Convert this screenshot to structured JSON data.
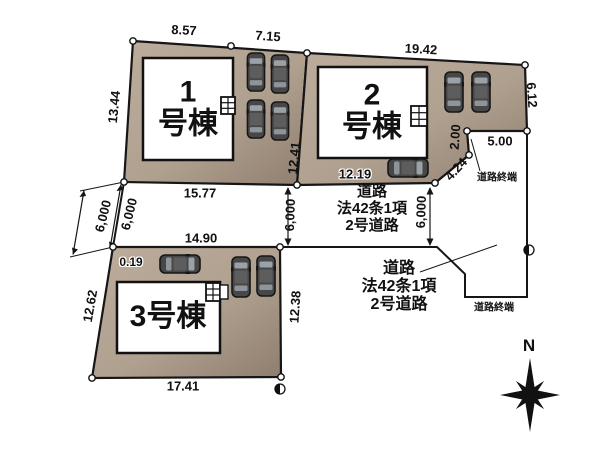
{
  "plots": [
    {
      "num": "1",
      "suffix": "号棟",
      "dims": {
        "top_left": "8.57",
        "top_right": "7.15",
        "left": "13.44",
        "right": "12.41"
      }
    },
    {
      "num": "2",
      "suffix": "号棟",
      "dims": {
        "top": "19.42",
        "right": "6.12",
        "notch_width": "5.00",
        "notch_height": "2.00",
        "notch_diagonal": "4.24",
        "bottom": "12.19"
      }
    },
    {
      "label": "3号棟",
      "dims": {
        "offset": "0.19",
        "left": "12.62",
        "right": "12.38",
        "bottom": "17.41"
      }
    }
  ],
  "road": {
    "top_width": "15.77",
    "bottom_width": "14.90",
    "width_labels": [
      "6,000",
      "6,000",
      "6,000",
      "6,000"
    ],
    "center_label": {
      "line1": "道路",
      "line2": "法42条1項",
      "line3": "2号道路"
    },
    "right_label": {
      "line1": "道路",
      "line2": "法42条1項",
      "line3": "2号道路"
    },
    "end_top": "道路終端",
    "end_bottom": "道路終端"
  },
  "compass": {
    "north": "N"
  },
  "colors": {
    "plot_fill": "#b5a595",
    "plot_fill_dark": "#8f7e6e",
    "line": "#161616",
    "building_fill": "#ffffff",
    "car_body": "#474747",
    "car_window": "#9aa2a8"
  }
}
